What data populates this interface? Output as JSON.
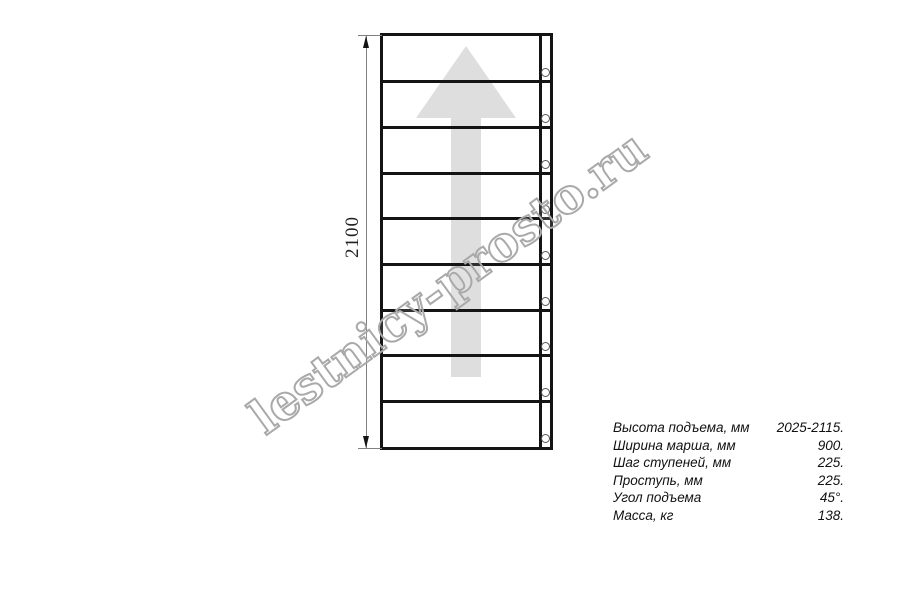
{
  "drawing": {
    "dimension_label": "2100",
    "steps": 9,
    "holes": 9,
    "arrow_direction": "up",
    "colors": {
      "line": "#141414",
      "dimension_line": "#808080",
      "arrow_fill": "#dedede",
      "watermark_outline": "#a9a9a9"
    }
  },
  "watermark": {
    "text": "lestnicy-prosto.ru"
  },
  "specs": {
    "rows": [
      {
        "label": "Высота подъема, мм",
        "value": "2025-2115."
      },
      {
        "label": "Ширина марша, мм",
        "value": "900."
      },
      {
        "label": "Шаг ступеней, мм",
        "value": "225."
      },
      {
        "label": "Проступь, мм",
        "value": "225."
      },
      {
        "label": "Угол подъема",
        "value": "45°."
      },
      {
        "label": "Масса, кг",
        "value": "138."
      }
    ]
  }
}
